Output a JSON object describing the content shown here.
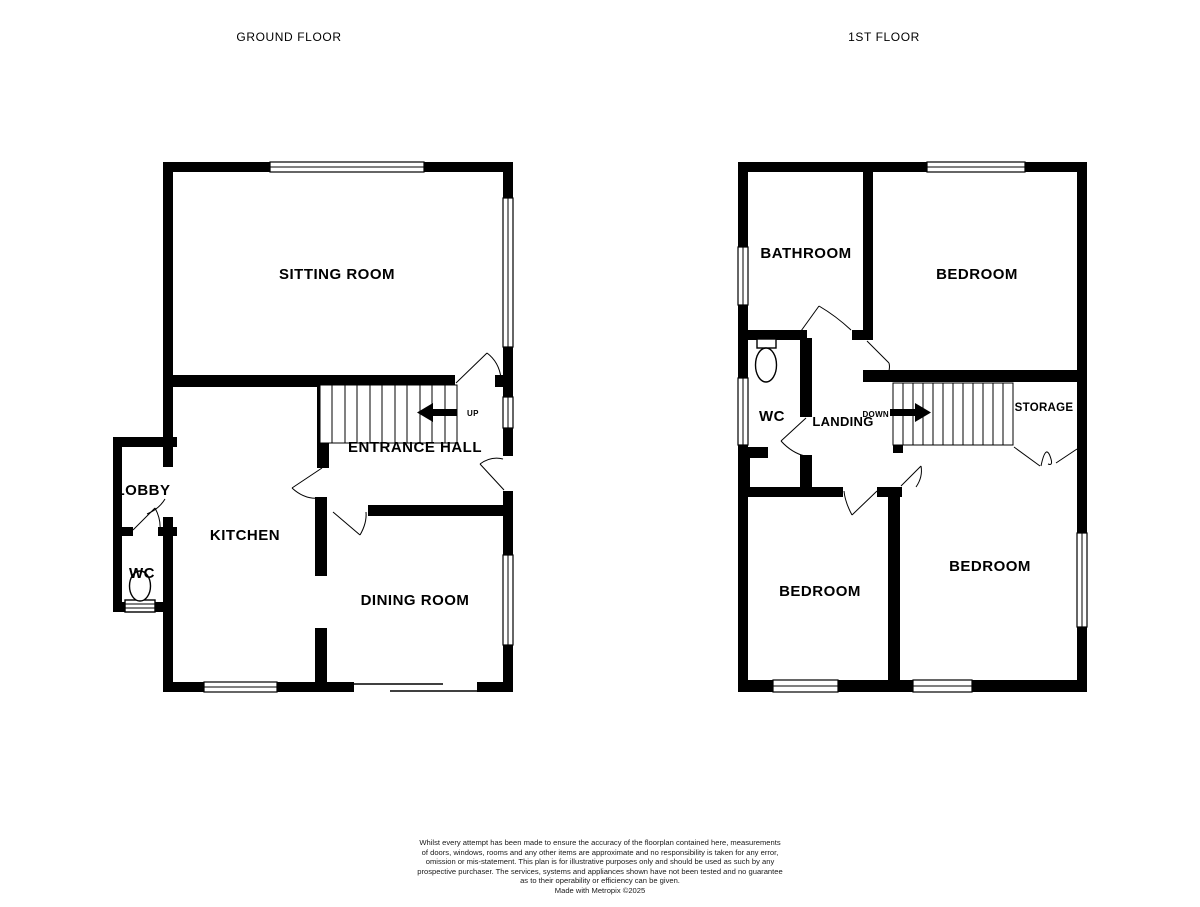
{
  "colors": {
    "wall": "#000000",
    "background": "#ffffff",
    "text": "#000000"
  },
  "ground_floor": {
    "title": "GROUND FLOOR",
    "rooms": {
      "sitting_room": "SITTING ROOM",
      "entrance_hall": "ENTRANCE HALL",
      "kitchen": "KITCHEN",
      "dining_room": "DINING ROOM",
      "lobby": "LOBBY",
      "wc": "WC"
    },
    "stair_direction": "UP"
  },
  "first_floor": {
    "title": "1ST FLOOR",
    "rooms": {
      "bathroom": "BATHROOM",
      "bedroom_top": "BEDROOM",
      "wc": "WC",
      "landing": "LANDING",
      "storage": "STORAGE",
      "bedroom_bottom_left": "BEDROOM",
      "bedroom_bottom_right": "BEDROOM"
    },
    "stair_direction": "DOWN"
  },
  "footer": {
    "disclaimer_lines": [
      "Whilst every attempt has been made to ensure the accuracy of the floorplan contained here, measurements",
      "of doors, windows, rooms and any other items are approximate and no responsibility is taken for any error,",
      "omission or mis-statement. This plan is for illustrative purposes only and should be used as such by any",
      "prospective purchaser. The services, systems and appliances shown have not been tested and no guarantee",
      "as to their operability or efficiency can be given."
    ],
    "credit": "Made with Metropix ©2025"
  }
}
